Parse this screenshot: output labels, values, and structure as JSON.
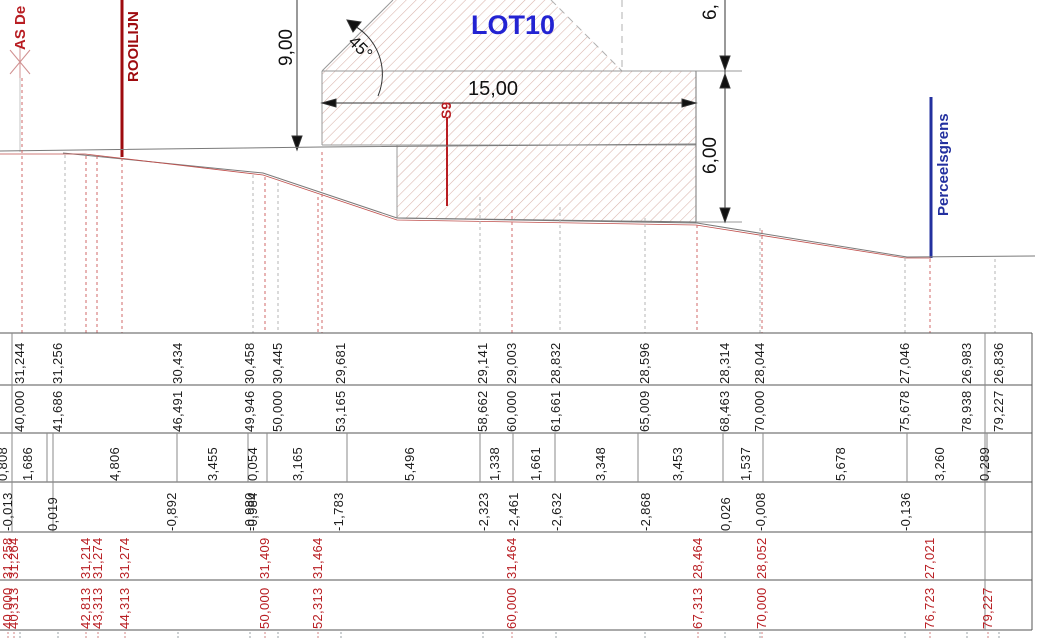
{
  "labels": {
    "as_line": "AS De",
    "rooilijn": "ROOILIJN",
    "lot": "LOT10",
    "angle": "45°",
    "dim_width": "15,00",
    "dim_left_height": "9,00",
    "dim_right_top": "6,",
    "dim_right_height": "6,00",
    "s9": "S9",
    "perceelsgrens": "Perceelsgrens"
  },
  "colors": {
    "red_text": "#b81d22",
    "rooilijn_red": "#9e0b0f",
    "lot_blue": "#2323d2",
    "perceelsgrens_navy": "#23309f",
    "hatch_pink": "#d8b2aa"
  },
  "profile_table": {
    "stations": [
      {
        "x": 20,
        "dist": "40,000",
        "elev": "31,244"
      },
      {
        "x": 58,
        "dist": "41,686",
        "elev": "31,256"
      },
      {
        "x": 178,
        "dist": "46,491",
        "elev": "30,434"
      },
      {
        "x": 250,
        "dist": "49,946",
        "elev": "30,458"
      },
      {
        "x": 278,
        "dist": "50,000",
        "elev": "30,445"
      },
      {
        "x": 341,
        "dist": "53,165",
        "elev": "29,681"
      },
      {
        "x": 483,
        "dist": "58,662",
        "elev": "29,141"
      },
      {
        "x": 512,
        "dist": "60,000",
        "elev": "29,003"
      },
      {
        "x": 556,
        "dist": "61,661",
        "elev": "28,832"
      },
      {
        "x": 645,
        "dist": "65,009",
        "elev": "28,596"
      },
      {
        "x": 725,
        "dist": "68,463",
        "elev": "28,314"
      },
      {
        "x": 760,
        "dist": "70,000",
        "elev": "28,044"
      },
      {
        "x": 905,
        "dist": "75,678",
        "elev": "27,046"
      },
      {
        "x": 967,
        "dist": "78,938",
        "elev": "26,983"
      },
      {
        "x": 999,
        "dist": "79,227",
        "elev": "26,836"
      }
    ],
    "segment_heights": [
      {
        "x": 3,
        "v": "0,808"
      },
      {
        "x": 28,
        "v": "1,686"
      },
      {
        "x": 115,
        "v": "4,806"
      },
      {
        "x": 213,
        "v": "3,455"
      },
      {
        "x": 253,
        "v": "0,054"
      },
      {
        "x": 298,
        "v": "3,165"
      },
      {
        "x": 410,
        "v": "5,496"
      },
      {
        "x": 495,
        "v": "1,338"
      },
      {
        "x": 536,
        "v": "1,661"
      },
      {
        "x": 601,
        "v": "3,348"
      },
      {
        "x": 678,
        "v": "3,453"
      },
      {
        "x": 746,
        "v": "1,537"
      },
      {
        "x": 841,
        "v": "5,678"
      },
      {
        "x": 940,
        "v": "3,260"
      },
      {
        "x": 985,
        "v": "0,289"
      }
    ],
    "point_offsets": [
      {
        "x": 8,
        "v": "-0,013"
      },
      {
        "x": 53,
        "v": "0,019"
      },
      {
        "x": 172,
        "v": "-0,892"
      },
      {
        "x": 250,
        "v": "-0,980"
      },
      {
        "x": 253,
        "v": "-0,984"
      },
      {
        "x": 339,
        "v": "-1,783"
      },
      {
        "x": 484,
        "v": "-2,323"
      },
      {
        "x": 514,
        "v": "-2,461"
      },
      {
        "x": 557,
        "v": "-2,632"
      },
      {
        "x": 646,
        "v": "-2,868"
      },
      {
        "x": 726,
        "v": "0,026"
      },
      {
        "x": 761,
        "v": "-0,008"
      },
      {
        "x": 906,
        "v": "-0,136"
      }
    ],
    "design_stations": [
      {
        "x": 8,
        "dist": "40,000",
        "elev": "31,258"
      },
      {
        "x": 14,
        "dist": "40,313",
        "elev": "31,264"
      },
      {
        "x": 86,
        "dist": "42,813",
        "elev": "31,214"
      },
      {
        "x": 98,
        "dist": "43,313",
        "elev": "31,274"
      },
      {
        "x": 125,
        "dist": "44,313",
        "elev": "31,274"
      },
      {
        "x": 265,
        "dist": "50,000",
        "elev": "31,409"
      },
      {
        "x": 318,
        "dist": "52,313",
        "elev": "31,464"
      },
      {
        "x": 512,
        "dist": "60,000",
        "elev": "31,464"
      },
      {
        "x": 698,
        "dist": "67,313",
        "elev": "28,464"
      },
      {
        "x": 762,
        "dist": "70,000",
        "elev": "28,052"
      },
      {
        "x": 930,
        "dist": "76,723",
        "elev": "27,021"
      },
      {
        "x": 988,
        "dist": "79,227",
        "elev": ""
      }
    ]
  }
}
